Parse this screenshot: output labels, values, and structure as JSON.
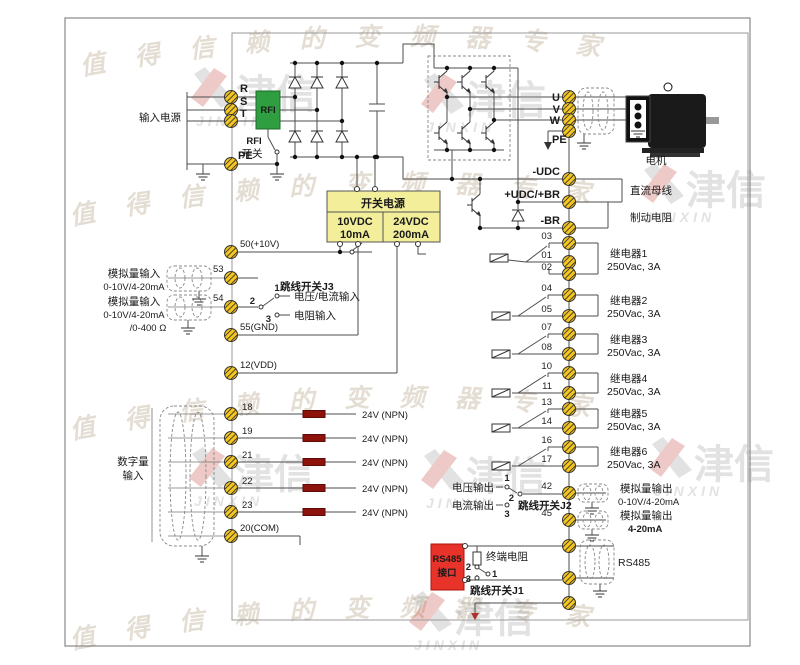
{
  "colors": {
    "terminal_fill": "#f3c623",
    "rfi_green": "#2f9e41",
    "psu_yellow": "#f2ee9a",
    "rs485_red": "#e8332a",
    "resistor_maroon": "#8c120b",
    "wire": "#4d4d4d"
  },
  "watermark": {
    "arc_text": "值得信赖的变频器专家",
    "logo_cn": "津信",
    "logo_en": "JINXIN"
  },
  "left": {
    "input_power": "输入电源",
    "r": "R",
    "s": "S",
    "t": "T",
    "pe": "PE",
    "rfi_filter": "RFI",
    "rfi_switch_l1": "RFI",
    "rfi_switch_l2": "开关",
    "t50": "50(+10V)",
    "t53": "53",
    "t54": "54",
    "t55": "55(GND)",
    "t12": "12(VDD)",
    "ai1_name": "模拟量输入",
    "ai1_range": "0-10V/4-20mA",
    "ai2_name": "模拟量输入",
    "ai2_range": "0-10V/4-20mA",
    "ai2_range2": "/0-400 Ω",
    "j3_label": "跳线开关J3",
    "j3_p1": "1",
    "j3_p2": "2",
    "j3_p3": "3",
    "j3_vi": "电压/电流输入",
    "j3_res": "电阻输入",
    "di_l1": "数字量",
    "di_l2": "输入",
    "di_terminals": [
      "18",
      "19",
      "21",
      "22",
      "23"
    ],
    "di_com": "20(COM)",
    "npn_label": "24V (NPN)"
  },
  "psu": {
    "title": "开关电源",
    "v1": "10VDC",
    "i1": "10mA",
    "v2": "24VDC",
    "i2": "200mA"
  },
  "right": {
    "u": "U",
    "v": "V",
    "w": "W",
    "pe": "PE",
    "motor": "电机",
    "udc_neg": "-UDC",
    "udc_pos": "+UDC/+BR",
    "br": "-BR",
    "dc_bus": "直流母线",
    "brake_res": "制动电阻",
    "relays": [
      {
        "terminals": [
          "03",
          "01",
          "02"
        ],
        "name": "继电器1",
        "rating": "250Vac, 3A"
      },
      {
        "terminals": [
          "04",
          "05"
        ],
        "name": "继电器2",
        "rating": "250Vac, 3A"
      },
      {
        "terminals": [
          "07",
          "08"
        ],
        "name": "继电器3",
        "rating": "250Vac, 3A"
      },
      {
        "terminals": [
          "10",
          "11"
        ],
        "name": "继电器4",
        "rating": "250Vac, 3A"
      },
      {
        "terminals": [
          "13",
          "14"
        ],
        "name": "继电器5",
        "rating": "250Vac, 3A"
      },
      {
        "terminals": [
          "16",
          "17"
        ],
        "name": "继电器6",
        "rating": "250Vac, 3A"
      }
    ],
    "vout": "电压输出",
    "iout": "电流输出",
    "j2_label": "跳线开关J2",
    "j2_p1": "1",
    "j2_p2": "2",
    "j2_p3": "3",
    "t42": "42",
    "t45": "45",
    "ao1_name": "模拟量输出",
    "ao1_range": "0-10V/4-20mA",
    "ao2_name": "模拟量输出",
    "ao2_range": "4-20mA",
    "rs485_l1": "RS485",
    "rs485_l2": "接口",
    "term_res": "终端电阻",
    "j1_label": "跳线开关J1",
    "j1_p1": "1",
    "j1_p2": "2",
    "j1_p3": "3",
    "rs485_ext": "RS485"
  }
}
